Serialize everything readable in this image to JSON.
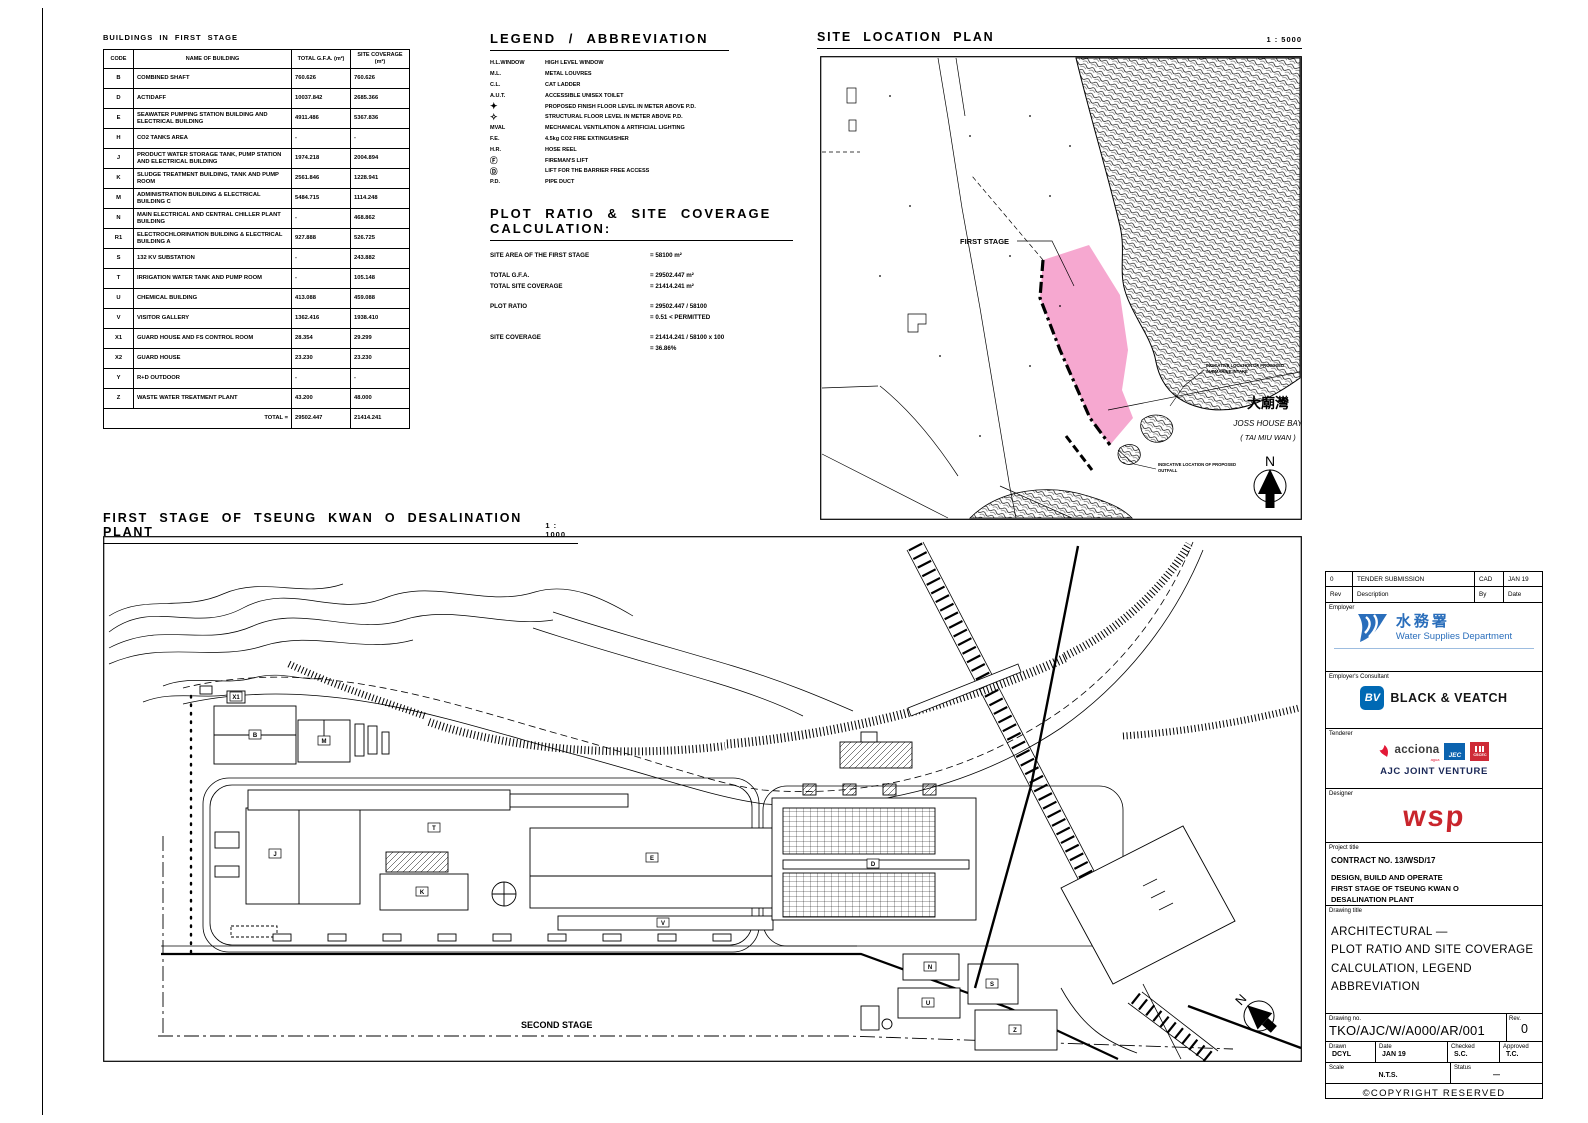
{
  "table": {
    "title": "BUILDINGS IN FIRST STAGE",
    "headers": [
      "CODE",
      "NAME OF BUILDING",
      "TOTAL G.F.A. (m²)",
      "SITE COVERAGE (m²)"
    ],
    "rows": [
      {
        "code": "B",
        "name": "COMBINED SHAFT",
        "gfa": "760.626",
        "coverage": "760.626"
      },
      {
        "code": "D",
        "name": "ACTIDAFF",
        "gfa": "10037.842",
        "coverage": "2685.366"
      },
      {
        "code": "E",
        "name": "SEAWATER PUMPING STATION BUILDING AND ELECTRICAL BUILDING",
        "gfa": "4911.486",
        "coverage": "5367.836"
      },
      {
        "code": "H",
        "name": "CO2 TANKS AREA",
        "gfa": "-",
        "coverage": "-"
      },
      {
        "code": "J",
        "name": "PRODUCT WATER STORAGE TANK, PUMP STATION AND ELECTRICAL BUILDING",
        "gfa": "1974.218",
        "coverage": "2004.894"
      },
      {
        "code": "K",
        "name": "SLUDGE TREATMENT BUILDING, TANK AND PUMP ROOM",
        "gfa": "2561.846",
        "coverage": "1228.941"
      },
      {
        "code": "M",
        "name": "ADMINISTRATION BUILDING & ELECTRICAL BUILDING C",
        "gfa": "5484.715",
        "coverage": "1114.248"
      },
      {
        "code": "N",
        "name": "MAIN ELECTRICAL AND CENTRAL CHILLER PLANT BUILDING",
        "gfa": "-",
        "coverage": "468.862"
      },
      {
        "code": "R1",
        "name": "ELECTROCHLORINATION BUILDING & ELECTRICAL BUILDING A",
        "gfa": "927.888",
        "coverage": "526.725"
      },
      {
        "code": "S",
        "name": "132 KV SUBSTATION",
        "gfa": "-",
        "coverage": "243.882"
      },
      {
        "code": "T",
        "name": "IRRIGATION WATER TANK AND PUMP ROOM",
        "gfa": "-",
        "coverage": "105.148"
      },
      {
        "code": "U",
        "name": "CHEMICAL BUILDING",
        "gfa": "413.088",
        "coverage": "459.088"
      },
      {
        "code": "V",
        "name": "VISITOR GALLERY",
        "gfa": "1362.416",
        "coverage": "1938.410"
      },
      {
        "code": "X1",
        "name": "GUARD HOUSE AND FS CONTROL ROOM",
        "gfa": "28.354",
        "coverage": "29.299"
      },
      {
        "code": "X2",
        "name": "GUARD HOUSE",
        "gfa": "23.230",
        "coverage": "23.230"
      },
      {
        "code": "Y",
        "name": "R+D OUTDOOR",
        "gfa": "-",
        "coverage": "-"
      },
      {
        "code": "Z",
        "name": "WASTE WATER TREATMENT PLANT",
        "gfa": "43.200",
        "coverage": "48.000"
      }
    ],
    "total_label": "TOTAL =",
    "total_gfa": "29502.447",
    "total_coverage": "21414.241"
  },
  "legend": {
    "title": "LEGEND / ABBREVIATION",
    "items": [
      {
        "key": "H.L.WINDOW",
        "desc": "HIGH LEVEL WINDOW"
      },
      {
        "key": "M.L.",
        "desc": "METAL LOUVRES"
      },
      {
        "key": "C.L.",
        "desc": "CAT LADDER"
      },
      {
        "key": "A.U.T.",
        "desc": "ACCESSIBLE UNISEX TOILET"
      },
      {
        "key": "✦",
        "desc": "PROPOSED FINISH FLOOR LEVEL IN METER ABOVE P.D."
      },
      {
        "key": "✧",
        "desc": "STRUCTURAL FLOOR LEVEL IN METER ABOVE P.D."
      },
      {
        "key": "MVAL",
        "desc": "MECHANICAL VENTILATION & ARTIFICIAL LIGHTING"
      },
      {
        "key": "F.E.",
        "desc": "4.5kg CO2 FIRE EXTINGUISHER"
      },
      {
        "key": "H.R.",
        "desc": "HOSE REEL"
      },
      {
        "key": "Ⓕ",
        "desc": "FIREMAN'S LIFT"
      },
      {
        "key": "Ⓓ",
        "desc": "LIFT FOR THE BARRIER FREE ACCESS"
      },
      {
        "key": "P.D.",
        "desc": "PIPE DUCT"
      }
    ]
  },
  "calc": {
    "title": "PLOT RATIO & SITE COVERAGE CALCULATION:",
    "rows": [
      {
        "label": "SITE AREA OF THE FIRST STAGE",
        "value": "= 58100 m²"
      },
      {
        "label": "TOTAL G.F.A.",
        "value": "= 29502.447 m²"
      },
      {
        "label": "TOTAL SITE COVERAGE",
        "value": "= 21414.241 m²"
      },
      {
        "label": "PLOT RATIO",
        "value": "= 29502.447 / 58100"
      },
      {
        "label": "",
        "value": "= 0.51  <  PERMITTED"
      },
      {
        "label": "SITE COVERAGE",
        "value": "= 21414.241 / 58100 x 100"
      },
      {
        "label": "",
        "value": "= 36.86%"
      }
    ]
  },
  "site_plan": {
    "title": "SITE LOCATION PLAN",
    "scale": "1 : 5000",
    "first_stage_label": "FIRST STAGE",
    "bay_name_cn": "大廟灣",
    "bay_name_en": "JOSS HOUSE BAY",
    "bay_name_en2": "( TAI MIU WAN )",
    "note_intake_1": "INDICATIVE LOCATION OF PROPOSED",
    "note_intake_2": "SUBMARINE INTAKE",
    "note_outfall_1": "INDICATIVE LOCATION OF PROPOSED",
    "note_outfall_2": "OUTFALL",
    "north": "N",
    "first_stage_fill": "#F6A8D0"
  },
  "main_plan": {
    "title": "FIRST STAGE OF TSEUNG KWAN O DESALINATION PLANT",
    "scale": "1 : 1000",
    "second_stage_label": "SECOND STAGE",
    "north": "N",
    "tags": {
      "x1": "X1",
      "b": "B",
      "m": "M",
      "j": "J",
      "t": "T",
      "k": "K",
      "e": "E",
      "v": "V",
      "d": "D",
      "n": "N",
      "u": "U",
      "s": "S",
      "z": "Z"
    }
  },
  "titleblock": {
    "revision": {
      "rev": "0",
      "description": "TENDER SUBMISSION",
      "by": "CAD",
      "date": "JAN 19",
      "h_rev": "Rev",
      "h_description": "Description",
      "h_by": "By",
      "h_date": "Date"
    },
    "employer": {
      "label": "Employer",
      "name_cn": "水務署",
      "name_en": "Water Supplies Department"
    },
    "consultant": {
      "label": "Employer's Consultant",
      "logo_text": "BV",
      "name": "BLACK & VEATCH"
    },
    "tenderer": {
      "label": "Tenderer",
      "acciona": "acciona",
      "acciona_sub": "agua",
      "jec": "JEC",
      "cscec": "CSCEC",
      "name": "AJC JOINT VENTURE"
    },
    "designer": {
      "label": "Designer",
      "logo_text": "wsp"
    },
    "project": {
      "label": "Project title",
      "contract": "CONTRACT NO. 13/WSD/17",
      "line1": "DESIGN, BUILD AND OPERATE",
      "line2": "FIRST STAGE OF TSEUNG KWAN O",
      "line3": "DESALINATION PLANT"
    },
    "drawing": {
      "label": "Drawing title",
      "line1": "ARCHITECTURAL —",
      "line2": "PLOT RATIO AND SITE COVERAGE",
      "line3": "CALCULATION, LEGEND",
      "line4": "ABBREVIATION"
    },
    "number": {
      "label": "Drawing no.",
      "value": "TKO/AJC/W/A000/AR/001",
      "rev_label": "Rev.",
      "rev": "0"
    },
    "meta": {
      "drawn_label": "Drawn",
      "drawn": "DCYL",
      "date_label": "Date",
      "date": "JAN 19",
      "checked_label": "Checked",
      "checked": "S.C.",
      "approved_label": "Approved",
      "approved": "T.C.",
      "scale_label": "Scale",
      "scale": "N.T.S.",
      "status_label": "Status",
      "status": "—"
    },
    "copyright": "©COPYRIGHT RESERVED",
    "colors": {
      "wsd_blue": "#2A6EBB",
      "bv_blue": "#0069B4",
      "jec_blue": "#0B63AF",
      "cscec_red": "#CE2B37",
      "acciona_red": "#E31937",
      "wsp_red": "#C9252C",
      "ajc_navy": "#1A2857"
    }
  }
}
